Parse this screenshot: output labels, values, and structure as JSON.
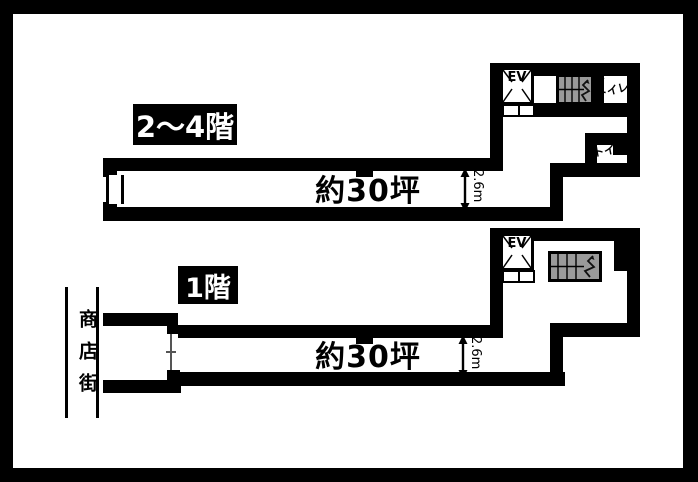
{
  "upper_plan": {
    "floor_label": "2〜4階",
    "area_label": "約30坪",
    "ceiling_height_label": "2.6m",
    "elevator_label": "EV",
    "toilet_upper_label": "トイレ",
    "toilet_lower_label": "トイレ"
  },
  "lower_plan": {
    "floor_label": "1階",
    "area_label": "約30坪",
    "ceiling_height_label": "2.6m",
    "elevator_label": "EV",
    "street_label": "商店街"
  },
  "colors": {
    "wall": "#000000",
    "background": "#ffffff",
    "stair_fill": "#9a9a9a",
    "label_box_bg": "#000000",
    "label_box_text": "#ffffff"
  }
}
